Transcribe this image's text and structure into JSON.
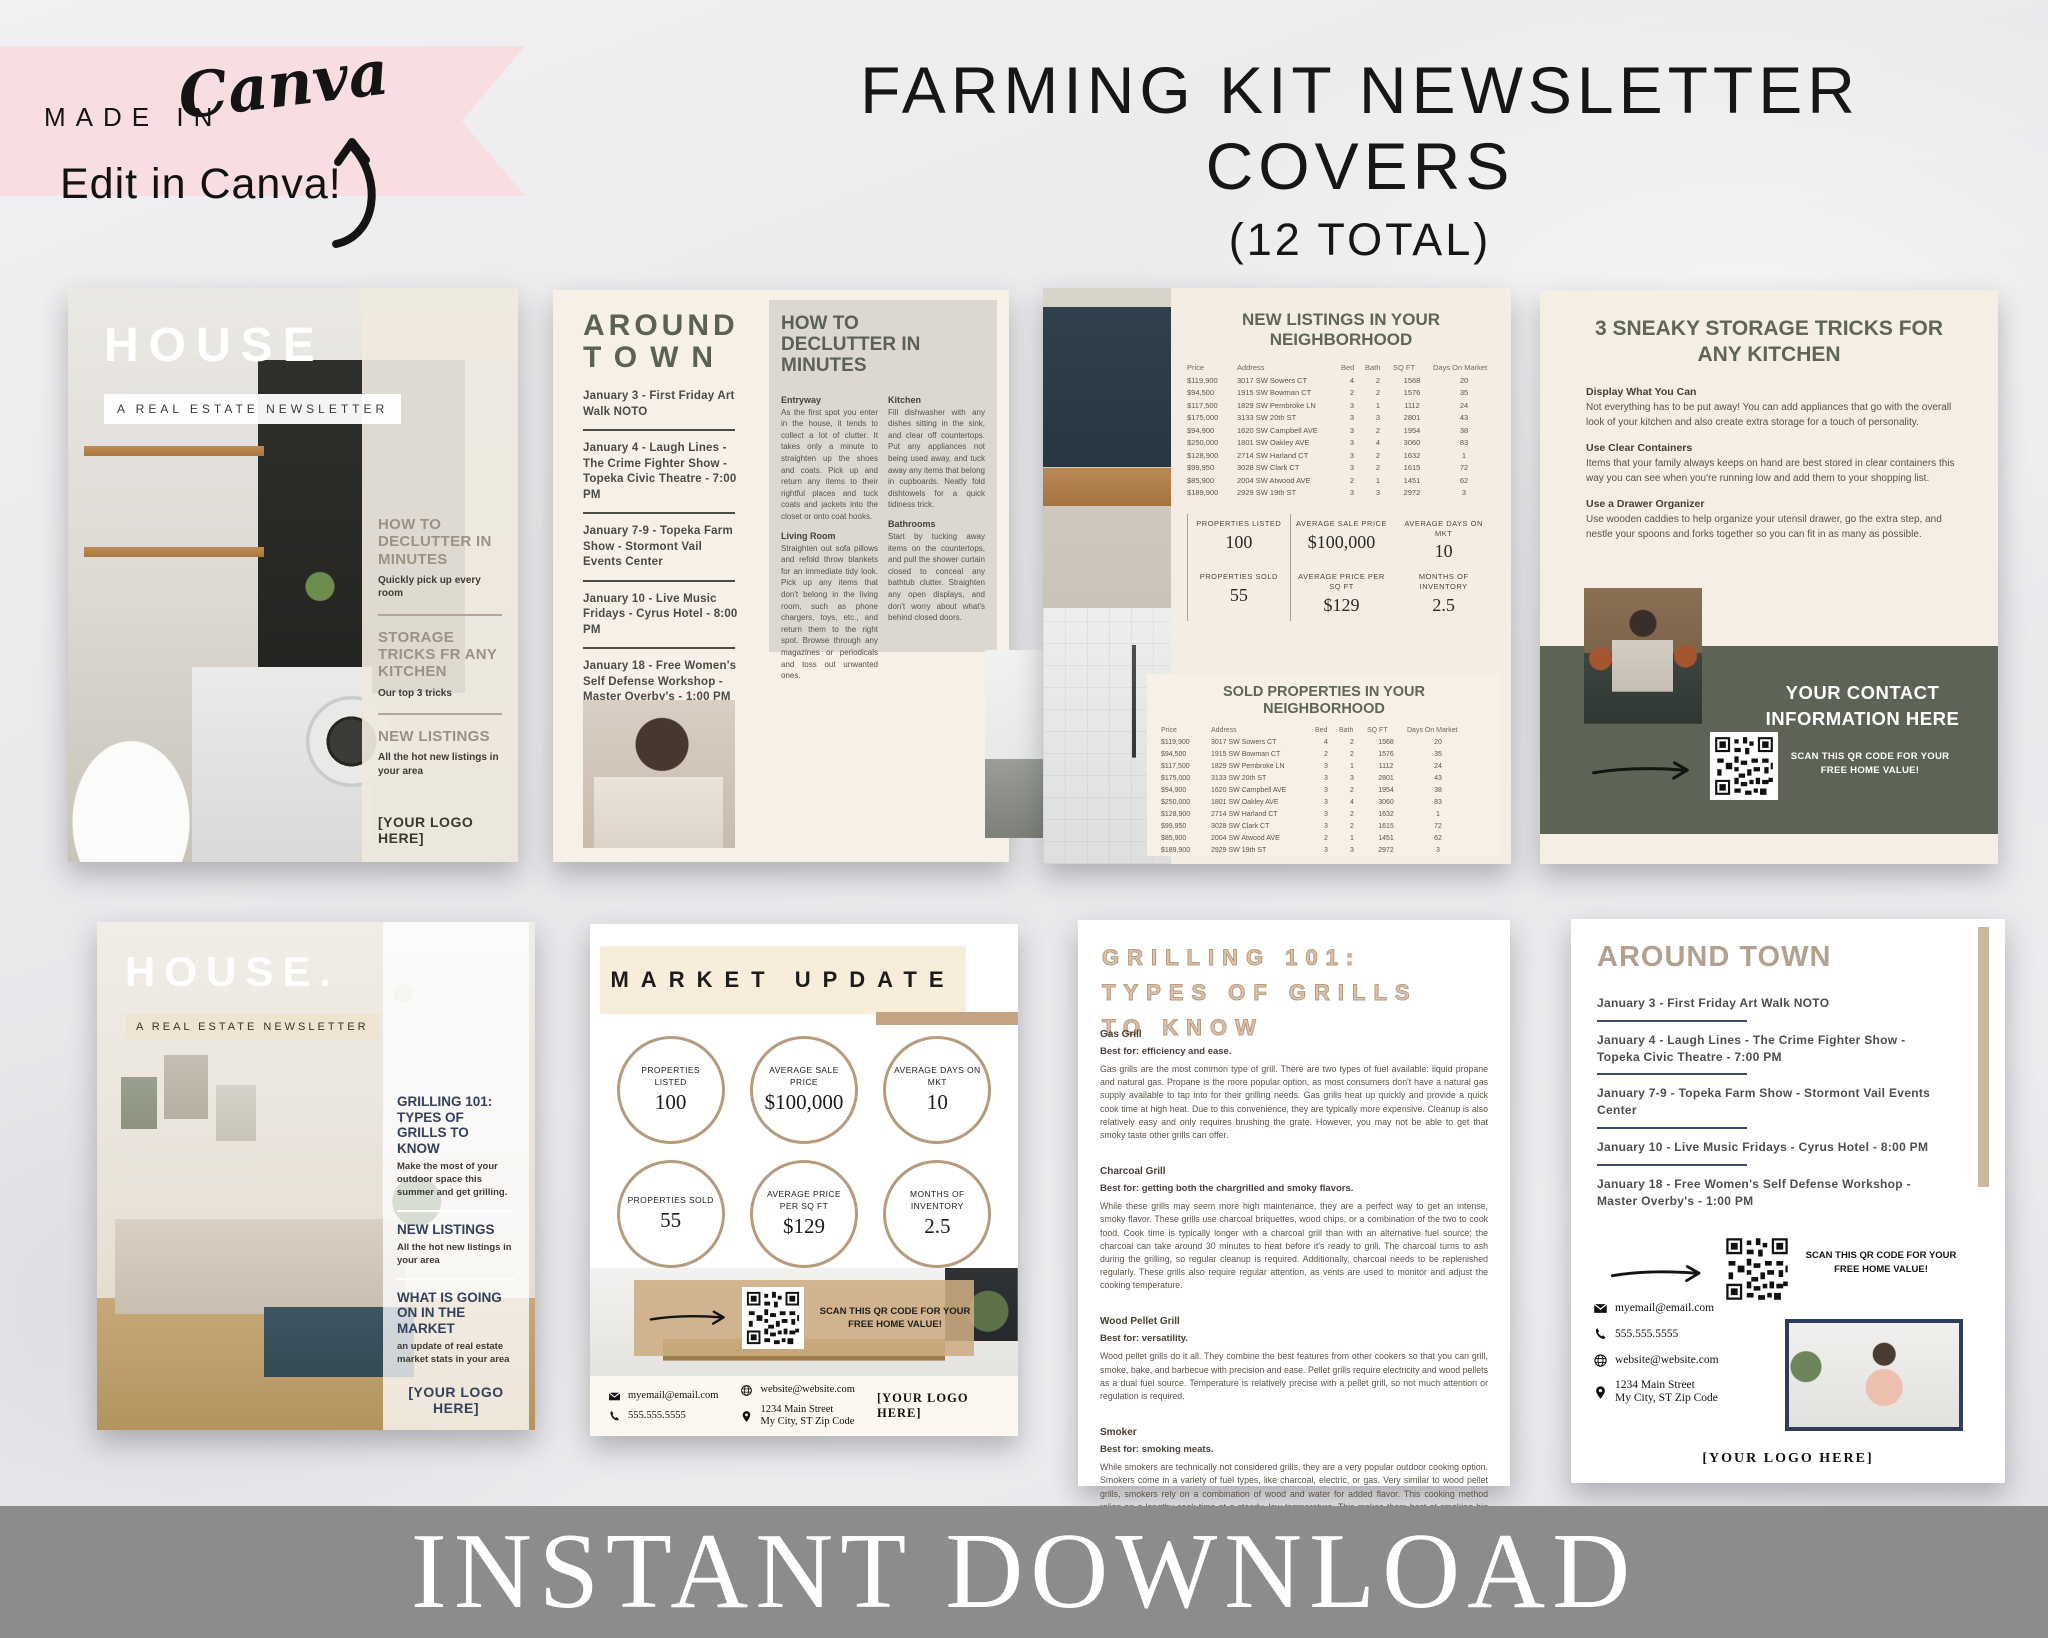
{
  "badge": {
    "made_in": "MADE IN",
    "brand": "Canva",
    "edit": "Edit in Canva!"
  },
  "header": {
    "title": "FARMING KIT NEWSLETTER COVERS",
    "subtitle": "(12 TOTAL)"
  },
  "banner": {
    "text": "INSTANT DOWNLOAD"
  },
  "colors": {
    "accent_tan": "#c5a485",
    "accent_olive": "#5e6455",
    "accent_navy": "#2e3d5e",
    "accent_pink": "#f8dee1",
    "banner_gray": "#8c8c8c"
  },
  "shared": {
    "masthead": "HOUSE",
    "tagline": "A REAL ESTATE NEWSLETTER",
    "logo_placeholder": "[YOUR LOGO HERE]",
    "qr_caption": "SCAN THIS QR CODE FOR YOUR FREE HOME VALUE!",
    "events": [
      "January 3 - First Friday Art Walk NOTO",
      "January 4 - Laugh Lines - The Crime Fighter Show - Topeka Civic Theatre - 7:00 PM",
      "January 7-9 - Topeka Farm Show - Stormont Vail Events Center",
      "January 10 - Live Music Fridays - Cyrus Hotel - 8:00 PM",
      "January 18 - Free Women's Self Defense Workshop - Master Overby's - 1:00 PM"
    ],
    "property_table": {
      "headers": [
        "Price",
        "Address",
        "Bed",
        "Bath",
        "SQ FT",
        "Days On Market"
      ],
      "rows": [
        [
          "$119,900",
          "3017 SW Sowers CT",
          "4",
          "2",
          "1568",
          "20"
        ],
        [
          "$94,500",
          "1915 SW Bowman CT",
          "2",
          "2",
          "1576",
          "35"
        ],
        [
          "$117,500",
          "1829 SW Pembroke LN",
          "3",
          "1",
          "1112",
          "24"
        ],
        [
          "$175,000",
          "3133 SW 20th ST",
          "3",
          "3",
          "2801",
          "43"
        ],
        [
          "$94,900",
          "1620 SW Campbell AVE",
          "3",
          "2",
          "1954",
          "38"
        ],
        [
          "$250,000",
          "1801 SW Oakley AVE",
          "3",
          "4",
          "3060",
          "83"
        ],
        [
          "$128,900",
          "2714 SW Harland CT",
          "3",
          "2",
          "1632",
          "1"
        ],
        [
          "$99,950",
          "3028 SW Clark CT",
          "3",
          "2",
          "1615",
          "72"
        ],
        [
          "$85,900",
          "2004 SW Atwood AVE",
          "2",
          "1",
          "1451",
          "62"
        ],
        [
          "$189,900",
          "2929 SW 19th ST",
          "3",
          "3",
          "2972",
          "3"
        ]
      ]
    },
    "market_stats": [
      {
        "label": "PROPERTIES LISTED",
        "value": "100"
      },
      {
        "label": "AVERAGE SALE PRICE",
        "value": "$100,000"
      },
      {
        "label": "AVERAGE DAYS ON MKT",
        "value": "10"
      },
      {
        "label": "PROPERTIES SOLD",
        "value": "55"
      },
      {
        "label": "AVERAGE PRICE PER SQ FT",
        "value": "$129"
      },
      {
        "label": "MONTHS OF INVENTORY",
        "value": "2.5"
      }
    ],
    "contact": {
      "email": "myemail@email.com",
      "phone": "555.555.5555",
      "website": "website@website.com",
      "address_line1": "1234 Main Street",
      "address_line2": "My City, ST Zip Code"
    }
  },
  "page1": {
    "sidebar": [
      {
        "h": "HOW TO DECLUTTER IN MINUTES",
        "p": "Quickly pick up every room"
      },
      {
        "h": "STORAGE TRICKS FR ANY KITCHEN",
        "p": "Our top 3 tricks"
      },
      {
        "h": "NEW LISTINGS",
        "p": "All the hot new listings in your area"
      }
    ]
  },
  "page2": {
    "title_line1": "AROUND",
    "title_line2": "TOWN",
    "article_title": "HOW TO DECLUTTER IN MINUTES",
    "sections_col1": [
      {
        "h": "Entryway",
        "p": "As the first spot you enter in the house, it tends to collect a lot of clutter. It takes only a minute to straighten up the shoes and coats. Pick up and return any items to their rightful places and tuck coats and jackets into the closet or onto coat hooks."
      },
      {
        "h": "Living Room",
        "p": "Straighten out sofa pillows and refold throw blankets for an immediate tidy look. Pick up any items that don't belong in the living room, such as phone chargers, toys, etc., and return them to the right spot. Browse through any magazines or periodicals and toss out unwanted ones."
      }
    ],
    "sections_col2": [
      {
        "h": "Kitchen",
        "p": "Fill dishwasher with any dishes sitting in the sink, and clear off countertops. Put any appliances not being used away, and tuck away any items that belong in cupboards. Neatly fold dishtowels for a quick tidiness trick."
      },
      {
        "h": "Bathrooms",
        "p": "Start by tucking away items on the countertops, and pull the shower curtain closed to conceal any bathtub clutter. Straighten any open displays, and don't worry about what's behind closed doors."
      }
    ]
  },
  "page3": {
    "new_title": "NEW LISTINGS IN YOUR NEIGHBORHOOD",
    "sold_title": "SOLD PROPERTIES IN YOUR NEIGHBORHOOD"
  },
  "page4": {
    "title": "3 SNEAKY STORAGE TRICKS FOR ANY KITCHEN",
    "tips": [
      {
        "h": "Display What You Can",
        "p": "Not everything has to be put away! You can add appliances that go with the overall look of your kitchen and also create extra storage for a touch of personality."
      },
      {
        "h": "Use Clear Containers",
        "p": "Items that your family always keeps on hand are best stored in clear containers this way you can see when you're running low and add them to your shopping list."
      },
      {
        "h": "Use a Drawer Organizer",
        "p": "Use wooden caddies to help organize your utensil drawer, go the extra step, and nestle your spoons and forks together so you can fit in as many as possible."
      }
    ],
    "banner_line1": "YOUR CONTACT",
    "banner_line2": "INFORMATION HERE"
  },
  "page5": {
    "masthead": "HOUSE.",
    "sidebar": [
      {
        "h": "GRILLING 101: TYPES OF GRILLS TO KNOW",
        "p": "Make the most of your outdoor space this summer and get grilling."
      },
      {
        "h": "NEW LISTINGS",
        "p": "All the hot new listings in your area"
      },
      {
        "h": "WHAT IS GOING ON IN THE MARKET",
        "p": "an update of real estate market stats in your area"
      }
    ]
  },
  "page6": {
    "title": "MARKET UPDATE"
  },
  "page7": {
    "title": "GRILLING 101: TYPES OF GRILLS TO KNOW",
    "sections": [
      {
        "h": "Gas Grill",
        "best": "Best for: efficiency and ease.",
        "p": "Gas grills are the most common type of grill. There are two types of fuel available: liquid propane and natural gas. Propane is the more popular option, as most consumers don't have a natural gas supply available to tap into for their grilling needs. Gas grills heat up quickly and provide a quick cook time at high heat. Due to this convenience, they are typically more expensive. Cleanup is also relatively easy and only requires brushing the grate. However, you may not be able to get that smoky taste other grills can offer."
      },
      {
        "h": "Charcoal Grill",
        "best": "Best for: getting both the chargrilled and smoky flavors.",
        "p": "While these grills may seem more high maintenance, they are a perfect way to get an intense, smoky flavor. These grills use charcoal briquettes, wood chips, or a combination of the two to cook food. Cook time is typically longer with a charcoal grill than with an alternative fuel source; the charcoal can take around 30 minutes to heat before it's ready to grill. The charcoal turns to ash during the grilling, so regular cleanup is required. Additionally, charcoal needs to be replenished regularly. These grills also require regular attention, as vents are used to monitor and adjust the cooking temperature."
      },
      {
        "h": "Wood Pellet Grill",
        "best": "Best for: versatility.",
        "p": "Wood pellet grills do it all. They combine the best features from other cookers so that you can grill, smoke, bake, and barbecue with precision and ease. Pellet grills require electricity and wood pellets as a dual fuel source. Temperature is relatively precise with a pellet grill, so not much attention or regulation is required."
      },
      {
        "h": "Smoker",
        "best": "Best for: smoking meats.",
        "p": "While smokers are technically not considered grills, they are a very popular outdoor cooking option. Smokers come in a variety of fuel types, like charcoal, electric, or gas. Very similar to wood pellet grills, smokers rely on a combination of wood and water for added flavor. This cooking method relies on a lengthy cook time at a steady, low temperature. This makes them best at smoking big racks or cuts of meat for a mouthwatering meal. For more details on these types of grills, read our How to Use a Smoker guide."
      }
    ]
  },
  "page8": {
    "title": "AROUND TOWN"
  }
}
